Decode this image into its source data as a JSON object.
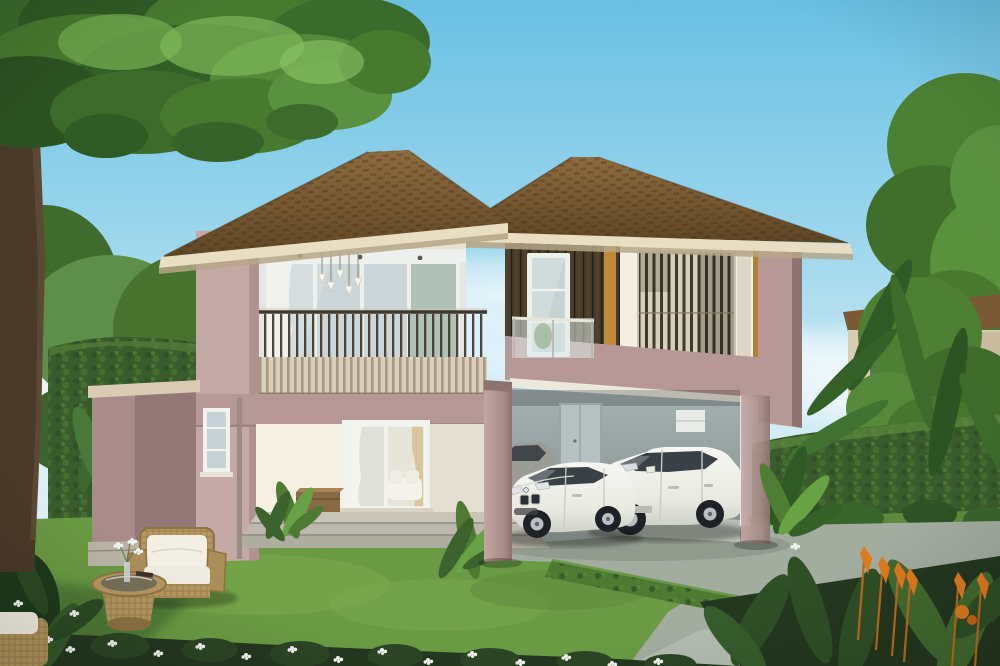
{
  "scene": {
    "type": "architectural-rendering",
    "description": "3D exterior rendering of a modern two-story tropical house with dusty-pink walls, brown tiled hip roofs, a slatted balcony, a white slat feature box, and a carport with two white cars, set in a landscaped garden.",
    "objects": [
      {
        "name": "house",
        "description": "two-story modern house, mauve-pink and cream walls"
      },
      {
        "name": "left-roof",
        "description": "brown tiled hip roof over left wing"
      },
      {
        "name": "right-roof",
        "description": "brown tiled hip roof over right wing"
      },
      {
        "name": "balcony",
        "description": "recessed second-floor balcony with wooden slat railing and glass sliding doors"
      },
      {
        "name": "pendant-lamps",
        "description": "cluster of white pendant lamps inside balcony"
      },
      {
        "name": "feature-box",
        "description": "white rounded frame window box with vertical bamboo slats"
      },
      {
        "name": "stair-window",
        "description": "tall narrow window with glass juliet balustrade"
      },
      {
        "name": "carport",
        "description": "open carport under right wing with gray interior and access door"
      },
      {
        "name": "sedan",
        "description": "white BMW 3-series style sedan"
      },
      {
        "name": "suv",
        "description": "white BMW X6 style SUV"
      },
      {
        "name": "garage-car",
        "description": "gray car partially visible inside garage"
      },
      {
        "name": "driveway",
        "description": "gray concrete driveway"
      },
      {
        "name": "lawn",
        "description": "green manicured lawn"
      },
      {
        "name": "front-steps",
        "description": "three wide steps to terrace with sliding glass door"
      },
      {
        "name": "garden-armchair",
        "description": "wicker armchair with white cushions"
      },
      {
        "name": "garden-table",
        "description": "round wicker table with glass top, vase and book"
      },
      {
        "name": "big-tree",
        "description": "large tree with trunk at left edge and canopy across top"
      },
      {
        "name": "hedges",
        "description": "trimmed dark green hedges around garden"
      },
      {
        "name": "flower-bed",
        "description": "white flower bed strip along bottom edge"
      },
      {
        "name": "orange-flowers",
        "description": "orange heliconia flower spikes bottom right"
      },
      {
        "name": "background-house",
        "description": "neighbouring cream house behind right hedge"
      }
    ]
  },
  "palette": {
    "sky_top": "#6fc3e4",
    "cloud": "#ffffff",
    "roof_fascia": "#e9ddc2",
    "wall_mauve_light": "#c5a9a7",
    "wall_mauve": "#b69896",
    "wall_mauve_shade": "#9d8380",
    "wall_cream": "#eee9db",
    "recess_wall": "#e3e6e5",
    "glass": "#c6d2d3",
    "glass_door": "#ccd6d8",
    "slat_cladding": "#4a3e2a",
    "amber_accent": "#c08a3c",
    "feature_box": "#f2eee2",
    "box_inner": "#d7cfba",
    "rail_band": "#d8d0bc",
    "garage_wall": "#9aa5a7",
    "garage_door": "#b7c1c2",
    "garage_floor": "#b7beb4",
    "device_box": "#e8ebe8",
    "lawn": "#6a9a43",
    "hedge": "#3a5c2c",
    "hedge_light": "#4e7a33",
    "driveway": "#a2ac9f",
    "trunk": "#4a3a29",
    "foliage_dark": "#2f5a24",
    "foliage": "#47792f",
    "foliage_light": "#6fa84d",
    "car_body": "#f2f3ef",
    "car_window": "#3a4146",
    "tire": "#1e2226",
    "wicker": "#b5975f",
    "cushion": "#f2efe5",
    "flower_white": "#f2f4ee",
    "flower_orange": "#df7a1e",
    "bg_house_wall": "#d8cdb0",
    "bg_house_roof": "#7a5a35",
    "step": "#c9c6b9",
    "bench_wood": "#8a6a44"
  }
}
